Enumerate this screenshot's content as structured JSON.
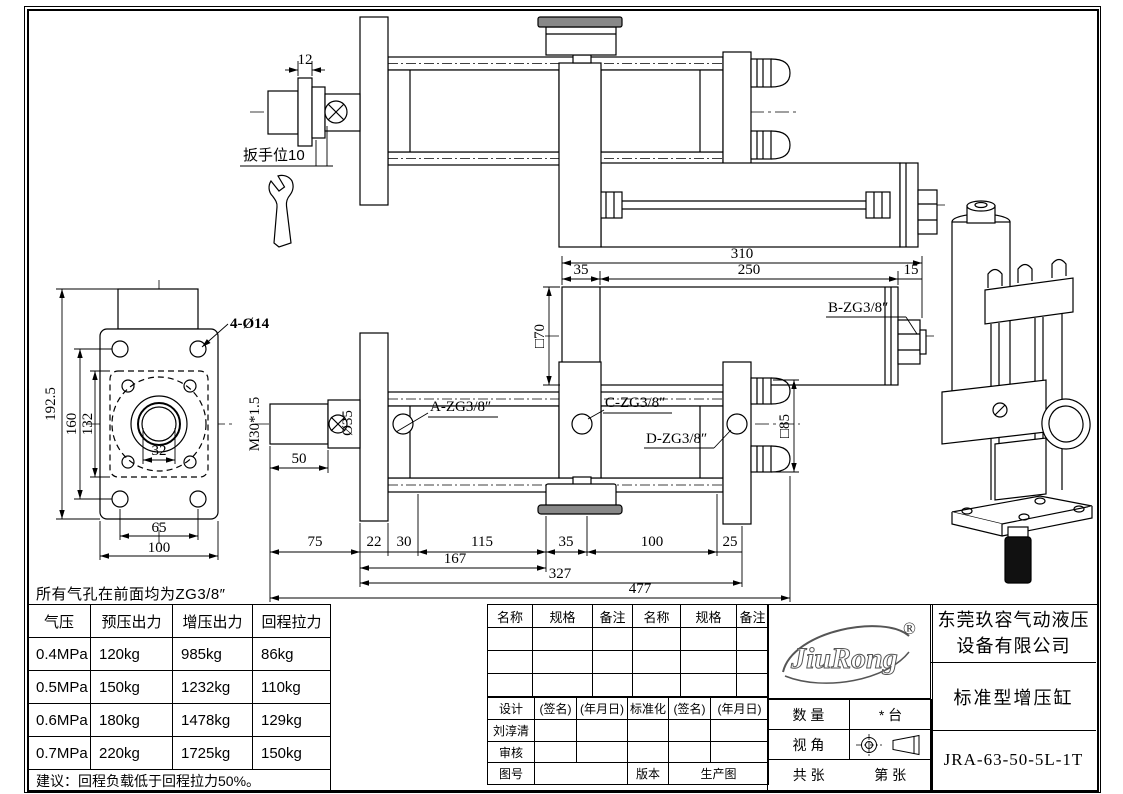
{
  "note": "所有气孔在前面均为ZG3/8″",
  "dims": {
    "d12": "12",
    "wrench": "扳手位10",
    "d310": "310",
    "d35": "35",
    "d250": "250",
    "d15": "15",
    "sq70": "□70",
    "sq85": "□85",
    "m30": "M30*1.5",
    "dia35": "Ø35",
    "d50": "50",
    "c75": "75",
    "c22": "22",
    "c30": "30",
    "c115": "115",
    "c35": "35",
    "c100": "100",
    "c25": "25",
    "d167": "167",
    "d327": "327",
    "d477": "477",
    "holes": "4-Ø14",
    "d1925": "192.5",
    "d160": "160",
    "d132": "132",
    "d32": "32",
    "d65": "65",
    "d100": "100"
  },
  "ports": {
    "a": "A-ZG3/8″",
    "b": "B-ZG3/8″",
    "c": "C-ZG3/8″",
    "d": "D-ZG3/8″"
  },
  "force_table": {
    "headers": [
      "气压",
      "预压出力",
      "增压出力",
      "回程拉力"
    ],
    "rows": [
      [
        "0.4MPa",
        "120kg",
        "985kg",
        "86kg"
      ],
      [
        "0.5MPa",
        "150kg",
        "1232kg",
        "110kg"
      ],
      [
        "0.6MPa",
        "180kg",
        "1478kg",
        "129kg"
      ],
      [
        "0.7MPa",
        "220kg",
        "1725kg",
        "150kg"
      ]
    ],
    "advice": "建议：回程负载低于回程拉力50%。"
  },
  "parts_table": {
    "headers": [
      "名称",
      "规格",
      "备注",
      "名称",
      "规格",
      "备注"
    ]
  },
  "sign_table": {
    "row1": [
      "设计",
      "(签名)",
      "(年月日)",
      "标准化",
      "(签名)",
      "(年月日)"
    ],
    "designer": "刘淳清",
    "reviewer_label": "审核",
    "drawing_no_label": "图号",
    "version_label": "版本",
    "version_value": "生产图"
  },
  "title_block": {
    "logo_text": "JiuRong",
    "registered": "®",
    "company_line1": "东莞玖容气动液压",
    "company_line2": "设备有限公司",
    "product_name": "标准型增压缸",
    "model": "JRA-63-50-5L-1T",
    "quantity_label": "数 量",
    "quantity_value": "* 台",
    "view_angle_label": "视 角",
    "sheets_label": "共 张",
    "sheet_label": "第 张"
  }
}
